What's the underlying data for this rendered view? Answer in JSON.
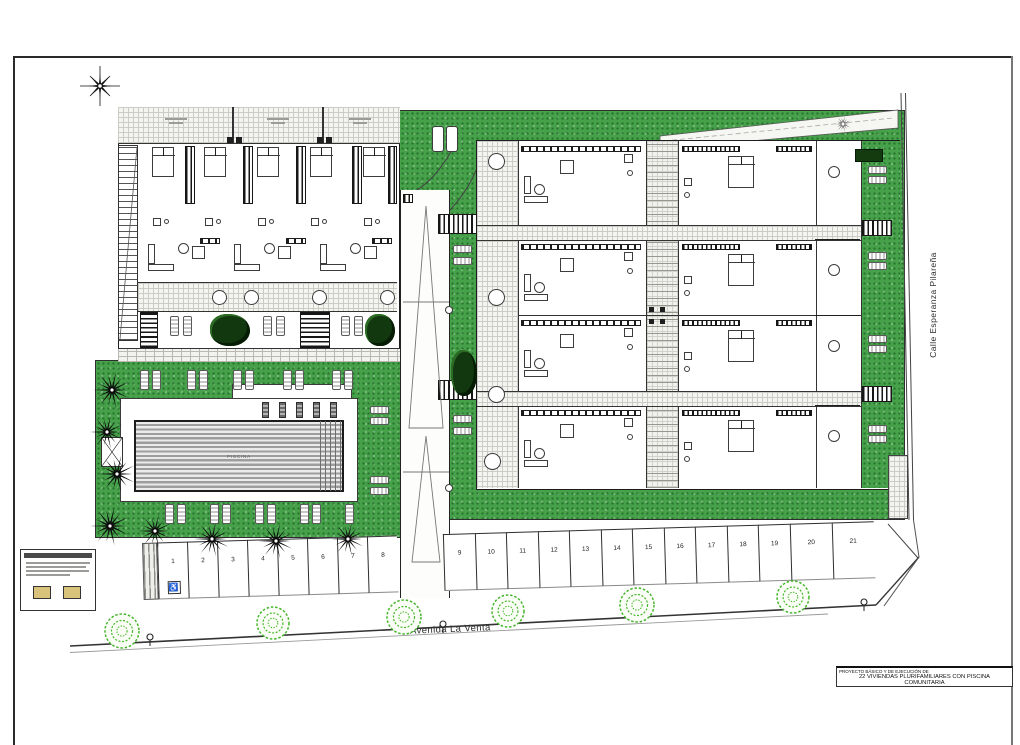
{
  "sheet": {
    "name": "site plan drawing"
  },
  "compass": {
    "icon": "north-arrow"
  },
  "streets": {
    "bottom_label": "Avenida La Venta",
    "right_label": "Calle Esperanza Pilareña"
  },
  "pool": {
    "label": "PISCINA"
  },
  "parking": {
    "spaces": [
      "1",
      "2",
      "3",
      "4",
      "5",
      "6",
      "7",
      "8",
      "9",
      "10",
      "11",
      "12",
      "13",
      "14",
      "15",
      "16",
      "17",
      "18",
      "19",
      "20",
      "21"
    ],
    "accessible_space": "1",
    "accessible_icon": "♿"
  },
  "title_block": {
    "line1": "PROYECTO BÁSICO Y DE EJECUCIÓN DE",
    "line2": "22 VIVIENDAS PLURIFAMILIARES CON PISCINA COMUNITARIA",
    "line3": "Y APARCAMIENTO PRIVADO"
  },
  "colors": {
    "grass_green": "#47a14b",
    "tree_green": "#44b62b",
    "line_black": "#222222"
  }
}
